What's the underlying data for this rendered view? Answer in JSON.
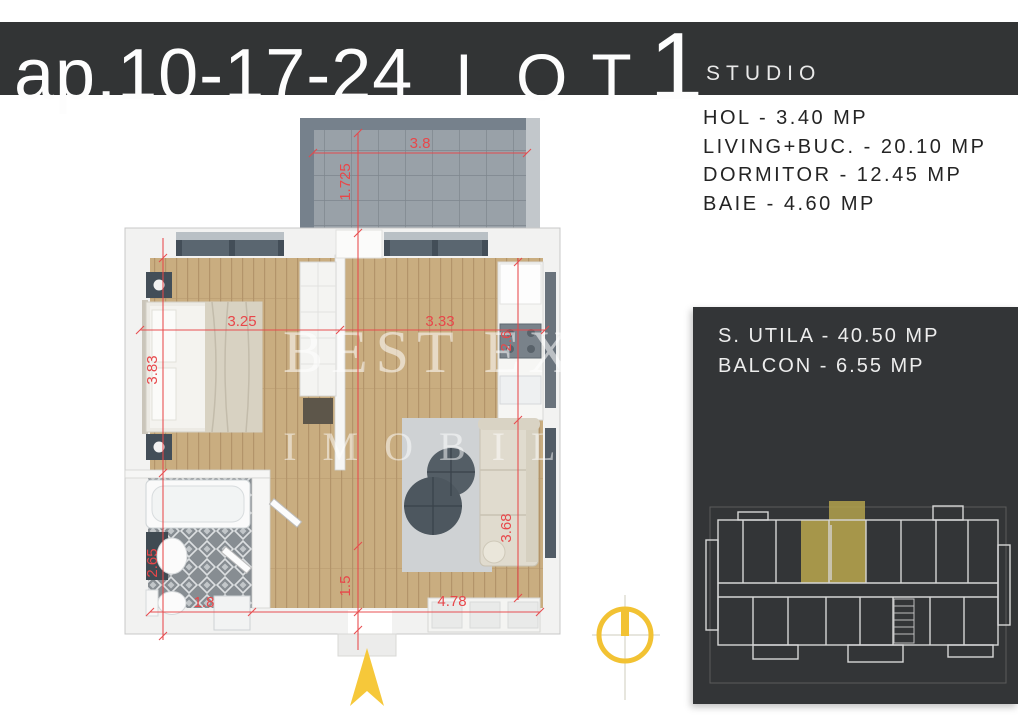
{
  "header": {
    "apartment": "ap.10-17-24",
    "lot": "LOT",
    "lot_number": "1",
    "type_label": "STUDIO"
  },
  "rooms": [
    "HOL - 3.40 MP",
    "LIVING+BUC. - 20.10 MP",
    "DORMITOR - 12.45 MP",
    "BAIE - 4.60 MP"
  ],
  "summary": [
    "S. UTILA - 40.50 MP",
    "BALCON - 6.55 MP"
  ],
  "watermark": {
    "line1": "BEST EXP",
    "line2": "IMOBILI"
  },
  "dims": {
    "balcony_w": "3.8",
    "balcony_h": "1.725",
    "bedroom_w": "3.25",
    "living_w": "3.33",
    "bedroom_h": "3.83",
    "bath_h": "2.65",
    "kitchen_h": "2.6",
    "sofa_h": "3.68",
    "hall_h": "1.5",
    "bath_w": "1.8",
    "bottom_w": "4.78"
  },
  "colors": {
    "header_bg": "#323435",
    "panel_bg": "#333537",
    "dimension_red": "#e8474a",
    "compass_yellow": "#f2c233",
    "unit_highlight": "#b3a14c",
    "wood_floor": "#c9ad80"
  }
}
